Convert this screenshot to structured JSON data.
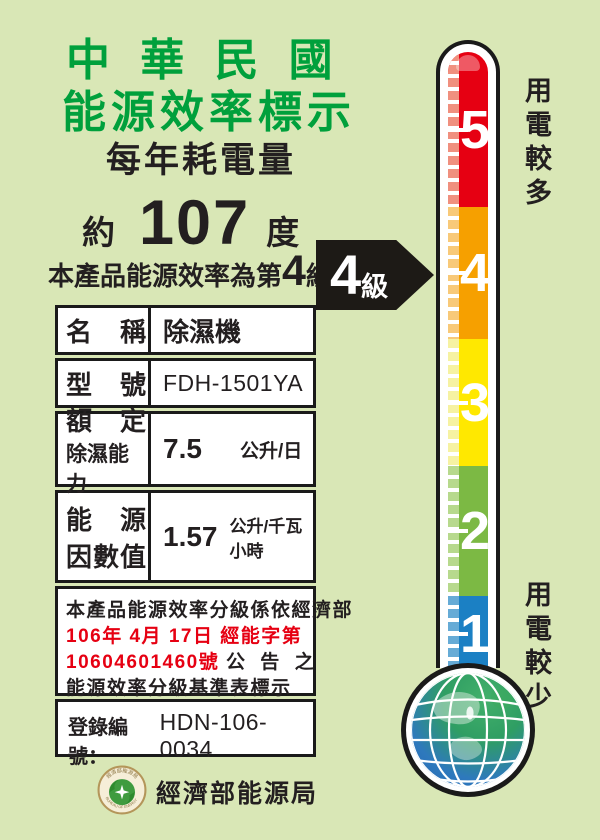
{
  "colors": {
    "background": "#d9e7b6",
    "title_green": "#00a03c",
    "text_black": "#231f20",
    "accent_red": "#e60012",
    "arrow_black": "#1d1a16",
    "level5_red": "#e60012",
    "level4_orange": "#f6a000",
    "level3_yellow": "#ffe800",
    "level2_green": "#7cb944",
    "level1_blue": "#1b80c4"
  },
  "header": {
    "title_line1": "中 華 民 國",
    "title_line2": "能源效率標示",
    "subtitle": "每年耗電量"
  },
  "consumption": {
    "approx": "約",
    "value": "107",
    "unit": "度"
  },
  "rating": {
    "sentence_prefix": "本產品能源效率為第",
    "sentence_grade": "4",
    "sentence_suffix": "級",
    "badge_grade": "4",
    "badge_suffix": "級"
  },
  "spec_table": {
    "rows": [
      {
        "label": "名　稱",
        "value": "除濕機"
      },
      {
        "label": "型　號",
        "value": "FDH-1501YA"
      },
      {
        "label_line1": "額　定",
        "label_line2": "除濕能力",
        "value": "7.5",
        "unit": "公升/日"
      },
      {
        "label_line1": "能　源",
        "label_line2": "因數值",
        "value": "1.57",
        "unit": "公升/千瓦小時"
      }
    ]
  },
  "note": {
    "line1": "本產品能源效率分級係依經濟部",
    "line2_red": "106年 4月 17日 經能字第",
    "line3_red": "10604601460號",
    "line3_black": "公 告 之",
    "line4": "能源效率分級基準表標示"
  },
  "registration": {
    "label": "登錄編號：",
    "value": "HDN-106-0034"
  },
  "footer": {
    "agency_name": "經濟部能源局",
    "seal_top_text": "經濟部能源局",
    "seal_bottom_text": "BUREAU OF ENERGY"
  },
  "thermometer": {
    "top_label": "用電較多",
    "bottom_label": "用電較少",
    "levels": [
      {
        "value": "5",
        "color": "#e60012",
        "strip": "#f0907f",
        "height": 155
      },
      {
        "value": "4",
        "color": "#f6a000",
        "strip": "#f8c979",
        "height": 132
      },
      {
        "value": "3",
        "color": "#ffe800",
        "strip": "#f6f2a2",
        "height": 127
      },
      {
        "value": "2",
        "color": "#7cb944",
        "strip": "#b7d98d",
        "height": 130
      },
      {
        "value": "1",
        "color": "#1b80c4",
        "strip": "#66abd6",
        "height": 76
      }
    ]
  }
}
